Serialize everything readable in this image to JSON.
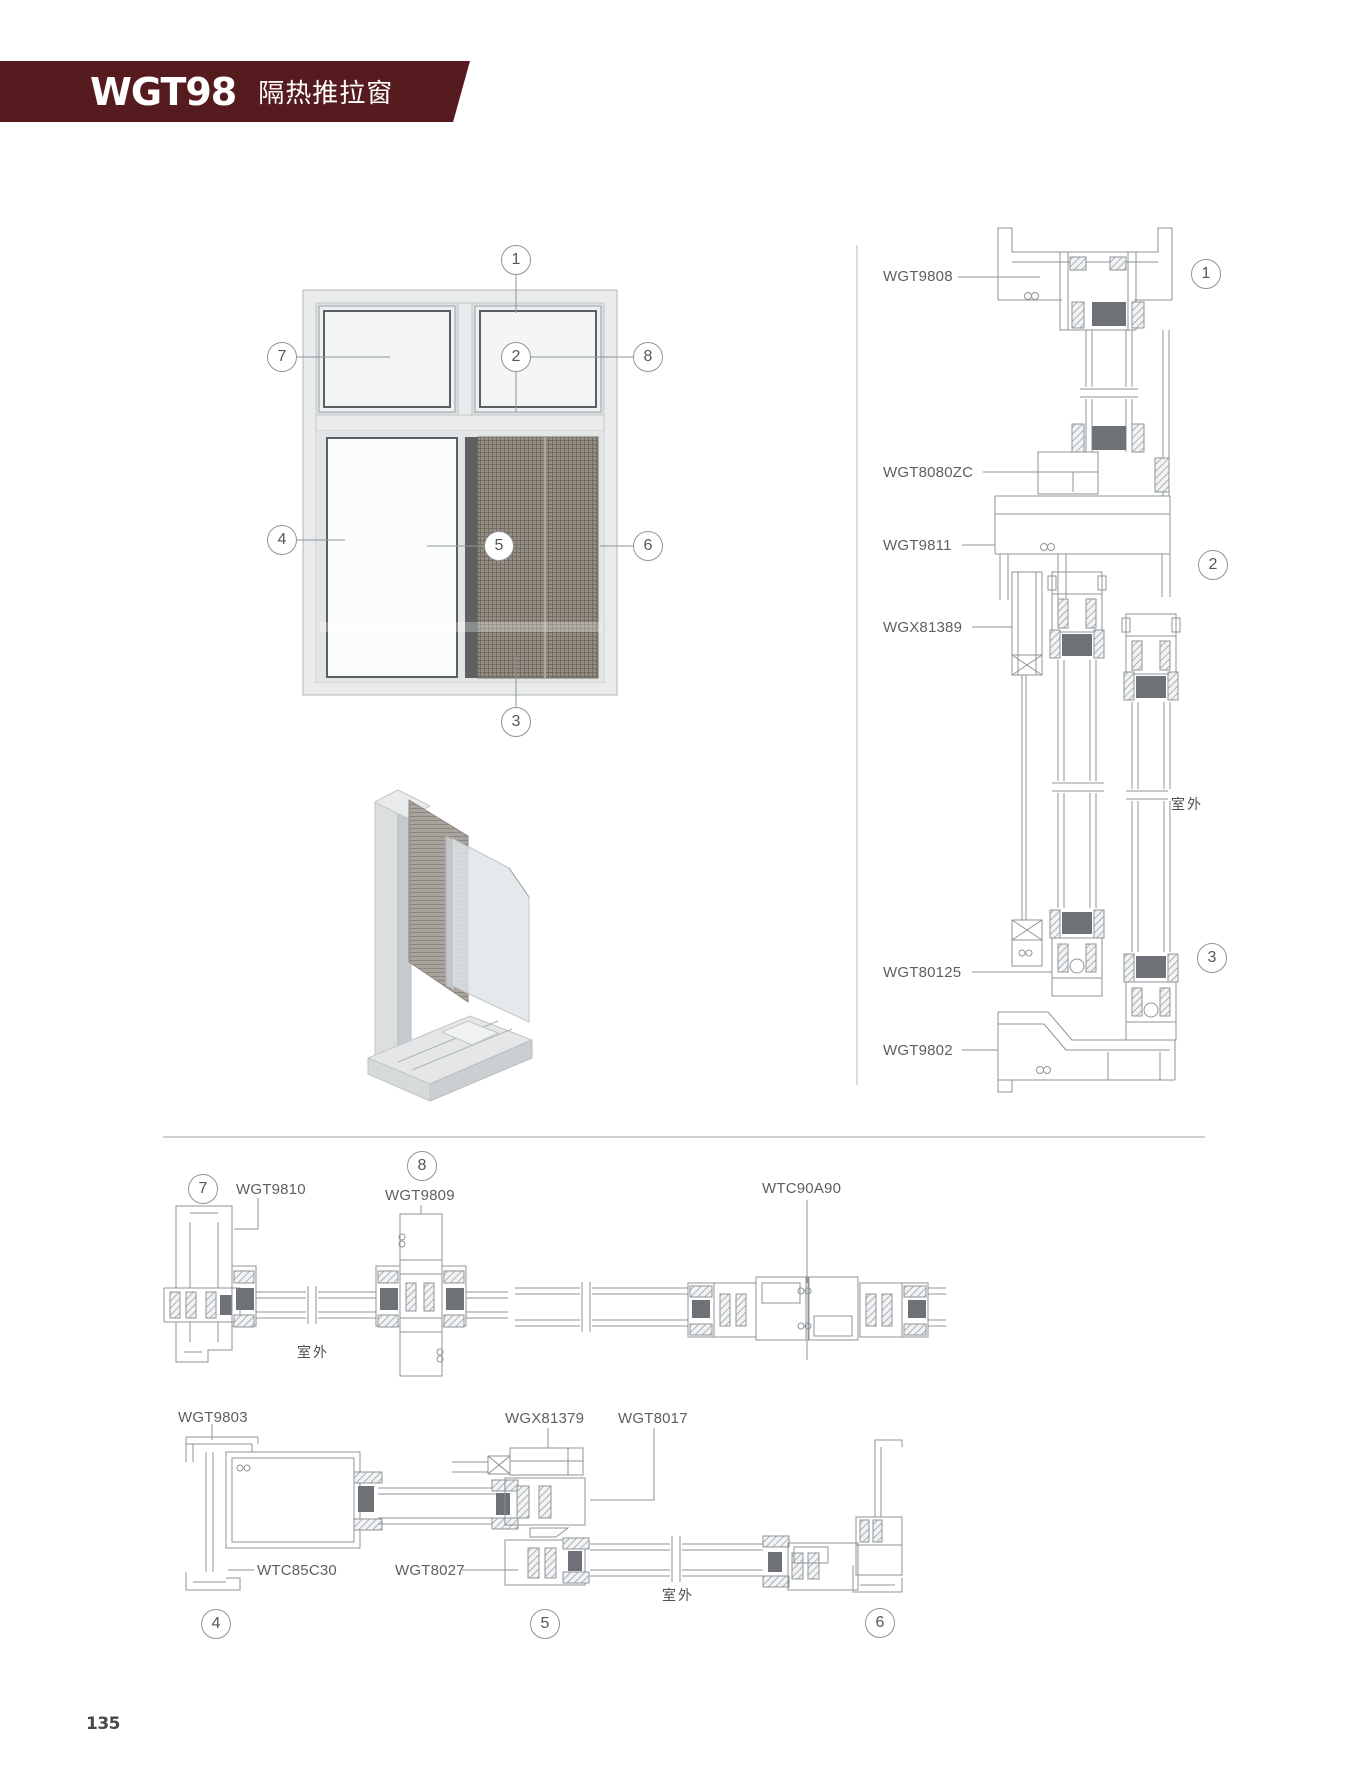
{
  "header": {
    "model": "WGT98",
    "subtitle": "隔热推拉窗",
    "bg_color": "#561B1F"
  },
  "page_number": "135",
  "elevation": {
    "callouts": [
      "1",
      "2",
      "3",
      "4",
      "5",
      "6",
      "7",
      "8"
    ]
  },
  "vertical_section": {
    "labels": [
      "WGT9808",
      "WGT8080ZC",
      "WGT9811",
      "WGX81389",
      "WGT80125",
      "WGT9802"
    ],
    "callouts": [
      "1",
      "2",
      "3"
    ],
    "outdoor_label": "室外"
  },
  "row1": {
    "jamb_callout": "7",
    "jamb_code": "WGT9810",
    "stile_callout": "8",
    "stile_code": "WGT9809",
    "outdoor_label": "室外",
    "mullion_code": "WTC90A90"
  },
  "row2": {
    "frame_code": "WGT9803",
    "track_code": "WGX81379",
    "interlock_code": "WGT8017",
    "adapter_code": "WTC85C30",
    "rail_code": "WGT8027",
    "outdoor_label": "室外",
    "callouts": [
      "4",
      "5",
      "6"
    ]
  }
}
